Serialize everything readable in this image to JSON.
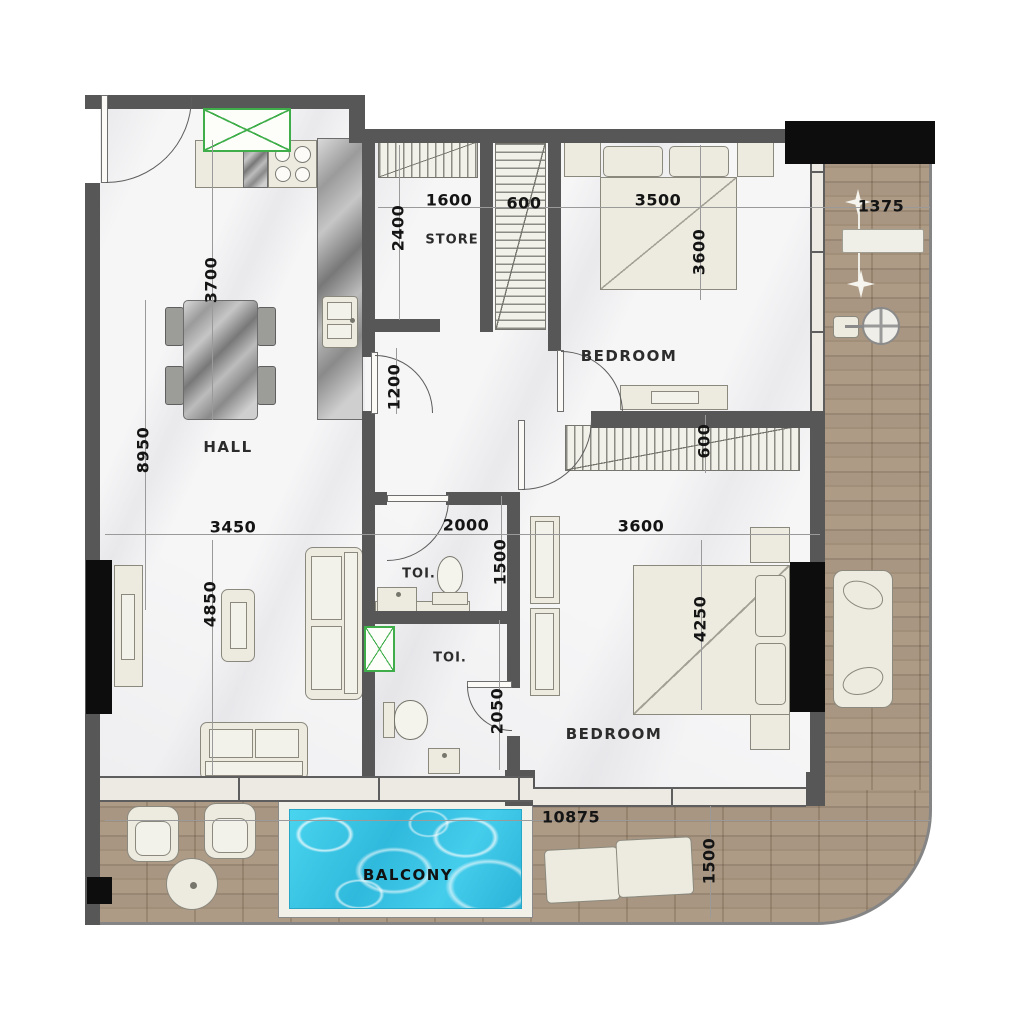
{
  "labels": {
    "hall": "HALL",
    "store": "STORE",
    "bedroom_top": "BEDROOM",
    "bedroom_bottom": "BEDROOM",
    "toilet_top": "TOI.",
    "toilet_bottom": "TOI.",
    "balcony": "BALCONY"
  },
  "dims": {
    "d3700": "3700",
    "d2400": "2400",
    "d1600": "1600",
    "d600_top": "600",
    "d3500": "3500",
    "d1375": "1375",
    "d3600_top": "3600",
    "d8950": "8950",
    "d1200": "1200",
    "d3450": "3450",
    "d2000": "2000",
    "d3600_mid": "3600",
    "d600_mid": "600",
    "d4850": "4850",
    "d1500_toilet": "1500",
    "d4250": "4250",
    "d2050": "2050",
    "d10875": "10875",
    "d1500_terrace": "1500"
  },
  "colors": {
    "wall": "#575757",
    "glazing_black": "#0d0d0d",
    "wood_deck": "#a3917f",
    "pool_water": "#3cc6e4",
    "shaft_green": "#3fae4a",
    "furniture": "#edebe0",
    "floor_marble": "#f6f6f7"
  }
}
